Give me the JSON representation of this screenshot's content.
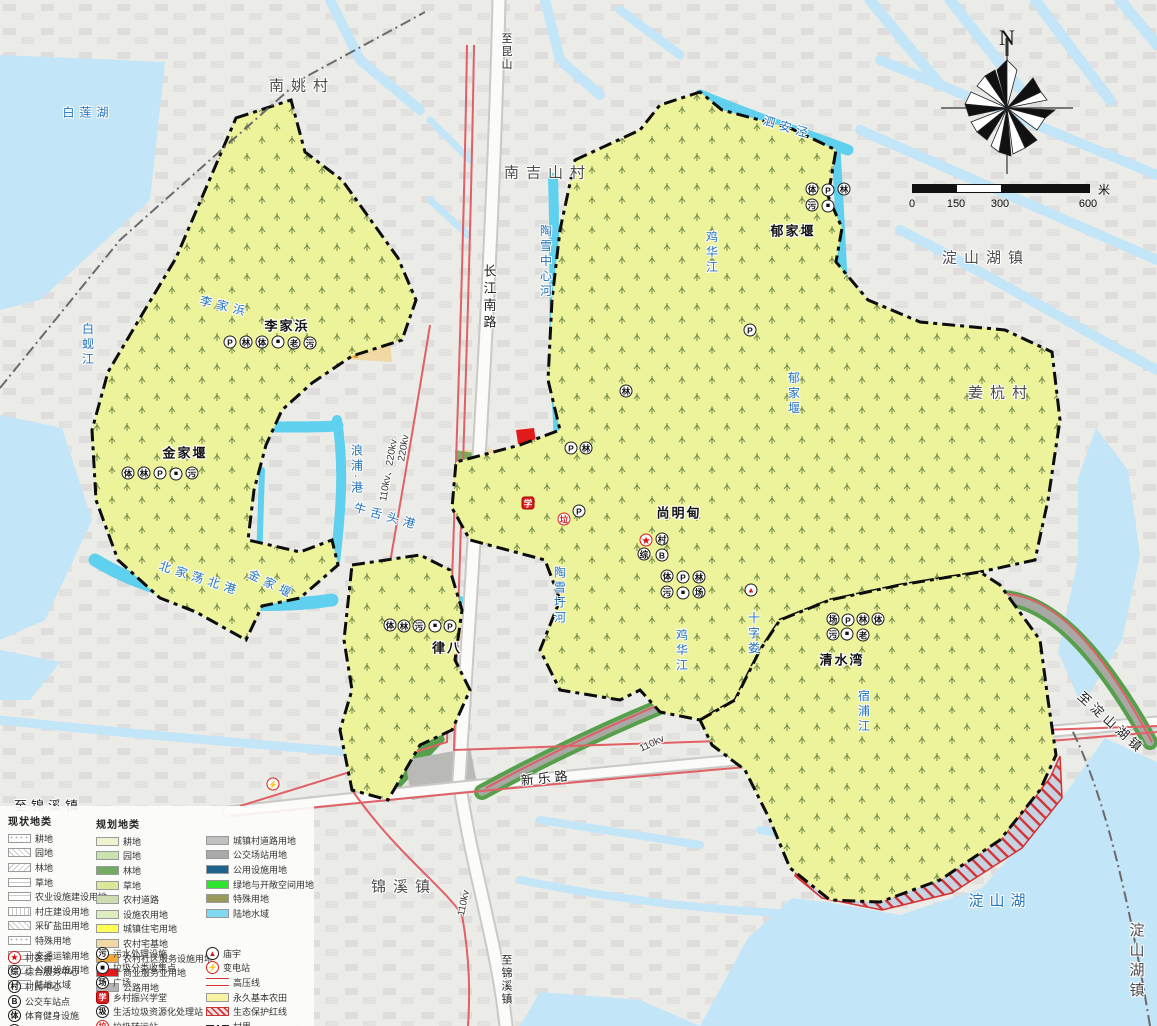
{
  "compass": {
    "label": "N"
  },
  "scale_bar": {
    "ticks": [
      "0",
      "150",
      "300",
      "600"
    ],
    "unit": "米"
  },
  "legend": {
    "current": {
      "header": "现状地类",
      "items": [
        {
          "label": "耕地",
          "pattern": "p-dots"
        },
        {
          "label": "园地",
          "pattern": "p-diag"
        },
        {
          "label": "林地",
          "pattern": "p-diag2"
        },
        {
          "label": "草地",
          "pattern": "p-horiz"
        },
        {
          "label": "农业设施建设用地",
          "pattern": "p-grid"
        },
        {
          "label": "村庄建设用地",
          "pattern": "p-vert"
        },
        {
          "label": "采矿盐田用地",
          "pattern": "p-diag"
        },
        {
          "label": "特殊用地",
          "pattern": "p-dots"
        },
        {
          "label": "交通运输用地",
          "pattern": "p-horiz"
        },
        {
          "label": "公用设施用地",
          "pattern": "p-diag2"
        },
        {
          "label": "陆地水域",
          "pattern": "p-grid"
        }
      ],
      "icons": [
        {
          "glyph": "★",
          "label": "村委会",
          "variant": "star"
        },
        {
          "glyph": "综",
          "label": "综合服务中心",
          "variant": ""
        },
        {
          "glyph": "村",
          "label": "村民中心",
          "variant": ""
        },
        {
          "glyph": "B",
          "label": "公交车站点",
          "variant": ""
        },
        {
          "glyph": "体",
          "label": "体育健身设施",
          "variant": ""
        },
        {
          "glyph": "P",
          "label": "停车场",
          "variant": ""
        },
        {
          "glyph": "林",
          "label": "公园",
          "variant": ""
        }
      ]
    },
    "planned": {
      "header": "规划地类",
      "items": [
        {
          "label": "耕地",
          "color": "#f0f2cf"
        },
        {
          "label": "园地",
          "color": "#c9e3ae"
        },
        {
          "label": "林地",
          "color": "#74ab62"
        },
        {
          "label": "草地",
          "color": "#d9e998"
        },
        {
          "label": "农村道路",
          "color": "#cfdcb2"
        },
        {
          "label": "设施农用地",
          "color": "#dcedc0"
        },
        {
          "label": "城镇住宅用地",
          "color": "#ffff55"
        },
        {
          "label": "农村宅基地",
          "color": "#f0d9a2"
        },
        {
          "label": "农村社区服务设施用地",
          "color": "#f5a83a"
        },
        {
          "label": "商业服务业用地",
          "color": "#e31a1c"
        },
        {
          "label": "公路用地",
          "color": "#b5b5b5"
        }
      ],
      "items2": [
        {
          "label": "城镇村道路用地",
          "color": "#c0c0c0"
        },
        {
          "label": "公交场站用地",
          "color": "#a9a9a9"
        },
        {
          "label": "公用设施用地",
          "color": "#1c6390"
        },
        {
          "label": "绿地与开敞空间用地",
          "color": "#2ee52e"
        },
        {
          "label": "特殊用地",
          "color": "#99995c"
        },
        {
          "label": "陆地水域",
          "color": "#7fd9f0"
        }
      ],
      "icons": [
        {
          "glyph": "污",
          "label": "污水处理设施",
          "variant": ""
        },
        {
          "glyph": "■",
          "label": "垃圾分类收集点",
          "variant": ""
        },
        {
          "glyph": "场",
          "label": "广场",
          "variant": ""
        },
        {
          "glyph": "学",
          "label": "乡村振兴学堂",
          "variant": "red-bg"
        },
        {
          "glyph": "圾",
          "label": "生活垃圾资源化处理站",
          "variant": ""
        },
        {
          "glyph": "垃",
          "label": "垃圾转运站",
          "variant": "red"
        },
        {
          "glyph": "老",
          "label": "老年活动中心",
          "variant": ""
        }
      ],
      "symbols": [
        {
          "glyph": "▲",
          "label": "庙宇",
          "variant": "tri",
          "type": "icon"
        },
        {
          "glyph": "⚡",
          "label": "变电站",
          "variant": "red",
          "type": "icon"
        },
        {
          "label": "高压线",
          "type": "double"
        },
        {
          "label": "永久基本农田",
          "type": "solid",
          "color": "#f7f3a0"
        },
        {
          "label": "生态保护红线",
          "type": "hatchred"
        },
        {
          "label": "村界",
          "type": "dashdot"
        },
        {
          "label": "镇界",
          "type": "dash"
        }
      ]
    }
  },
  "map_labels": [
    {
      "text": "南姚村",
      "cls": "town",
      "x": 302,
      "y": 85
    },
    {
      "text": "至昆山",
      "cls": "road-v sm",
      "x": 506,
      "y": 52
    },
    {
      "text": "南吉山村",
      "cls": "town",
      "x": 548,
      "y": 172
    },
    {
      "text": "泗安泾",
      "cls": "river",
      "x": 788,
      "y": 127,
      "rot": 17
    },
    {
      "text": "淀山湖镇",
      "cls": "town",
      "x": 986,
      "y": 257
    },
    {
      "text": "郁家堰",
      "cls": "vbold",
      "x": 793,
      "y": 230
    },
    {
      "text": "姜杭村",
      "cls": "town",
      "x": 1001,
      "y": 392
    },
    {
      "text": "白莲湖",
      "cls": "river",
      "x": 88,
      "y": 112
    },
    {
      "text": "李家浜",
      "cls": "river",
      "x": 225,
      "y": 306,
      "rot": 14
    },
    {
      "text": "李家浜",
      "cls": "vbold",
      "x": 287,
      "y": 325
    },
    {
      "text": "白蚬江",
      "cls": "river-v",
      "x": 88,
      "y": 345
    },
    {
      "text": "金家堰",
      "cls": "vbold",
      "x": 185,
      "y": 452
    },
    {
      "text": "金家堰",
      "cls": "river",
      "x": 272,
      "y": 584,
      "rot": 26
    },
    {
      "text": "北家荡北港",
      "cls": "river",
      "x": 200,
      "y": 578,
      "rot": 18
    },
    {
      "text": "浪浦·港",
      "cls": "river-v",
      "x": 357,
      "y": 470
    },
    {
      "text": "牛舌头港",
      "cls": "river",
      "x": 387,
      "y": 516,
      "rot": 16
    },
    {
      "text": "长江南路",
      "cls": "road-v",
      "x": 489,
      "y": 298
    },
    {
      "text": "110kv、220kv",
      "cls": "kv",
      "x": 387,
      "y": 470,
      "rot": -80
    },
    {
      "text": "220kv",
      "cls": "kv",
      "x": 404,
      "y": 448,
      "rot": -80
    },
    {
      "text": "陶雪中心河",
      "cls": "river-v",
      "x": 546,
      "y": 262
    },
    {
      "text": "陶雪圩河",
      "cls": "river-v",
      "x": 560,
      "y": 596
    },
    {
      "text": "鸡华江",
      "cls": "river-v",
      "x": 712,
      "y": 253
    },
    {
      "text": "鸡华江",
      "cls": "river-v",
      "x": 682,
      "y": 651
    },
    {
      "text": "郁家堰",
      "cls": "river-v",
      "x": 794,
      "y": 394
    },
    {
      "text": "尚明甸",
      "cls": "vbold",
      "x": 679,
      "y": 512
    },
    {
      "text": "十字娄",
      "cls": "river-v",
      "x": 754,
      "y": 634
    },
    {
      "text": "清水湾",
      "cls": "vbold",
      "x": 842,
      "y": 659
    },
    {
      "text": "宿浦江",
      "cls": "river-v",
      "x": 864,
      "y": 712
    },
    {
      "text": "新乐路",
      "cls": "road",
      "x": 546,
      "y": 777,
      "rot": -6
    },
    {
      "text": "锦溪镇",
      "cls": "town",
      "x": 404,
      "y": 886
    },
    {
      "text": "至锦溪镇",
      "cls": "road",
      "x": 48,
      "y": 805
    },
    {
      "text": "至锦溪镇",
      "cls": "road-v sm",
      "x": 506,
      "y": 980
    },
    {
      "text": "110kv",
      "cls": "kv",
      "x": 464,
      "y": 903,
      "rot": -78
    },
    {
      "text": "110kv",
      "cls": "kv",
      "x": 652,
      "y": 744,
      "rot": -25
    },
    {
      "text": "淀山湖",
      "cls": "riverbig",
      "x": 1000,
      "y": 900
    },
    {
      "text": "淀山湖镇",
      "cls": "town-v",
      "x": 1136,
      "y": 962
    },
    {
      "text": "至淀山湖镇",
      "cls": "road",
      "x": 1112,
      "y": 722,
      "rot": 42
    },
    {
      "text": "律八",
      "cls": "vbold",
      "x": 447,
      "y": 647
    }
  ],
  "map_icons": [
    {
      "x": 230,
      "y": 342,
      "g": "P"
    },
    {
      "x": 246,
      "y": 342,
      "g": "林"
    },
    {
      "x": 262,
      "y": 342,
      "g": "体"
    },
    {
      "x": 278,
      "y": 342,
      "g": "■",
      "v": "sq"
    },
    {
      "x": 294,
      "y": 343,
      "g": "老"
    },
    {
      "x": 310,
      "y": 343,
      "g": "污"
    },
    {
      "x": 128,
      "y": 473,
      "g": "体"
    },
    {
      "x": 144,
      "y": 473,
      "g": "林"
    },
    {
      "x": 160,
      "y": 473,
      "g": "P"
    },
    {
      "x": 176,
      "y": 474,
      "g": "■",
      "v": "sq"
    },
    {
      "x": 192,
      "y": 473,
      "g": "污"
    },
    {
      "x": 812,
      "y": 189,
      "g": "体"
    },
    {
      "x": 828,
      "y": 190,
      "g": "P"
    },
    {
      "x": 844,
      "y": 189,
      "g": "林"
    },
    {
      "x": 812,
      "y": 205,
      "g": "污"
    },
    {
      "x": 828,
      "y": 206,
      "g": "■",
      "v": "sq"
    },
    {
      "x": 750,
      "y": 330,
      "g": "P"
    },
    {
      "x": 626,
      "y": 391,
      "g": "林"
    },
    {
      "x": 571,
      "y": 448,
      "g": "P"
    },
    {
      "x": 586,
      "y": 448,
      "g": "林"
    },
    {
      "x": 528,
      "y": 503,
      "g": "学",
      "v": "red-bg"
    },
    {
      "x": 564,
      "y": 519,
      "g": "垃",
      "v": "red"
    },
    {
      "x": 579,
      "y": 511,
      "g": "P"
    },
    {
      "x": 646,
      "y": 540,
      "g": "★",
      "v": "star"
    },
    {
      "x": 662,
      "y": 539,
      "g": "村"
    },
    {
      "x": 644,
      "y": 554,
      "g": "综"
    },
    {
      "x": 662,
      "y": 555,
      "g": "B"
    },
    {
      "x": 667,
      "y": 576,
      "g": "体"
    },
    {
      "x": 683,
      "y": 577,
      "g": "P"
    },
    {
      "x": 699,
      "y": 577,
      "g": "林"
    },
    {
      "x": 667,
      "y": 592,
      "g": "污"
    },
    {
      "x": 683,
      "y": 593,
      "g": "■",
      "v": "sq"
    },
    {
      "x": 699,
      "y": 592,
      "g": "场"
    },
    {
      "x": 751,
      "y": 590,
      "g": "▲",
      "v": "tri"
    },
    {
      "x": 833,
      "y": 619,
      "g": "场"
    },
    {
      "x": 848,
      "y": 620,
      "g": "P"
    },
    {
      "x": 863,
      "y": 619,
      "g": "林"
    },
    {
      "x": 878,
      "y": 619,
      "g": "体"
    },
    {
      "x": 833,
      "y": 634,
      "g": "污"
    },
    {
      "x": 847,
      "y": 634,
      "g": "■",
      "v": "sq"
    },
    {
      "x": 863,
      "y": 635,
      "g": "老"
    },
    {
      "x": 390,
      "y": 625,
      "g": "体"
    },
    {
      "x": 404,
      "y": 626,
      "g": "林"
    },
    {
      "x": 419,
      "y": 626,
      "g": "污"
    },
    {
      "x": 435,
      "y": 626,
      "g": "■",
      "v": "sq"
    },
    {
      "x": 450,
      "y": 626,
      "g": "P"
    },
    {
      "x": 273,
      "y": 784,
      "g": "⚡",
      "v": "red"
    }
  ]
}
